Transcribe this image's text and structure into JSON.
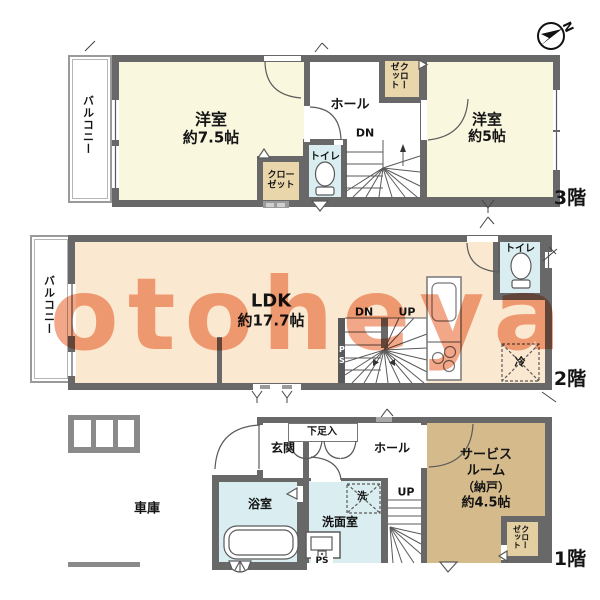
{
  "watermark": "otoheya",
  "compass": {
    "label": "N"
  },
  "colors": {
    "wall": "#686868",
    "room_cream": "#FAF7DF",
    "room_peach": "#FBE8D1",
    "room_blue": "#DAEEF1",
    "closet_tan": "#E9D6AB",
    "service_tan": "#D5BA8B",
    "watermark_salmon": "#F19B78"
  },
  "f3": {
    "floor_label": "3階",
    "balcony": "バルコニー",
    "western1_name": "洋室",
    "western1_size": "約7.5帖",
    "western2_name": "洋室",
    "western2_size": "約5帖",
    "hall": "ホール",
    "toilet": "トイレ",
    "closet_top": "クローゼット",
    "closet_bottom": "クローゼット",
    "dn": "DN"
  },
  "f2": {
    "floor_label": "2階",
    "balcony": "バルコニー",
    "ldk_name": "LDK",
    "ldk_size": "約17.7帖",
    "toilet": "トイレ",
    "fridge": "冷",
    "dn": "DN",
    "up": "UP",
    "ps": "PS"
  },
  "f1": {
    "floor_label": "1階",
    "garage": "車庫",
    "entrance": "玄関",
    "shoe_box": "下足入",
    "hall": "ホール",
    "service_l1": "サービス",
    "service_l2": "ルーム",
    "service_l3": "（納戸）",
    "service_l4": "約4.5帖",
    "bath": "浴室",
    "washroom": "洗面室",
    "washer": "洗",
    "closet": "クローゼット",
    "up": "UP",
    "ps": "PS"
  }
}
